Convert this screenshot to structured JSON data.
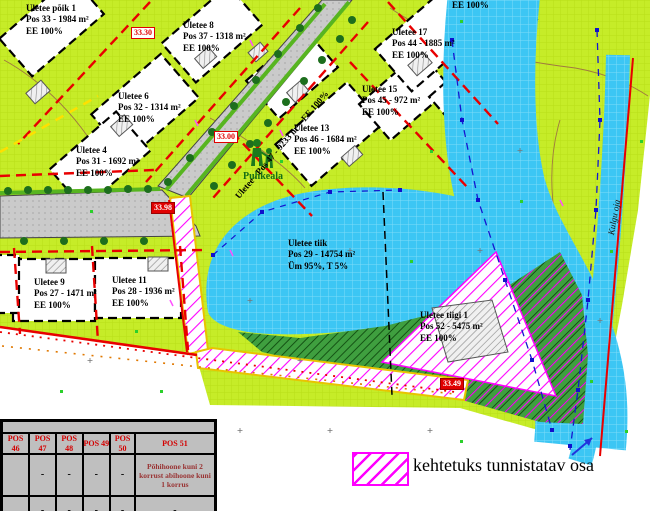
{
  "plots": [
    {
      "l1": "Uletee põik 1",
      "l2": "Pos 33 - 1984 m²",
      "l3": "EE 100%"
    },
    {
      "l1": "Uletee 8",
      "l2": "Pos 37 - 1318 m²",
      "l3": "EE 100%"
    },
    {
      "l1": "Uletee 6",
      "l2": "Pos 32 - 1314 m²",
      "l3": "EE 100%"
    },
    {
      "l1": "Uletee 4",
      "l2": "Pos 31 - 1692 m²",
      "l3": "EE 100%"
    },
    {
      "l1": "Uletee 9",
      "l2": "Pos 27 - 1471 m²",
      "l3": "EE 100%"
    },
    {
      "l1": "Uletee 11",
      "l2": "Pos 28 - 1936 m²",
      "l3": "EE 100%"
    },
    {
      "l1": "Uletee 17",
      "l2": "Pos 44 - 1885 m²",
      "l3": "EE 100%"
    },
    {
      "l1": "Uletee 15",
      "l2": "Pos 45 - 972 m²",
      "l3": "EE 100%"
    },
    {
      "l1": "Uletee 13",
      "l2": "Pos 46 - 1684 m²",
      "l3": "EE 100%"
    },
    {
      "l1": "Uletee tiigi 1",
      "l2": "Pos 52 - 5475 m²",
      "l3": "EE 100%"
    }
  ],
  "pond": {
    "l1": "Uletee tiik",
    "l2": "Pos 29 - 14754 m²",
    "l3": "Üm 95%, T 5%"
  },
  "road_label": "Uletee - Pos 47 - 9233 m² - EE 100%",
  "partial_label": "EE 100%",
  "recreation_label": "Puhkeala",
  "stream_label": "Kulgu oja",
  "elevation_markers": [
    {
      "value": "33.30",
      "style": "outline"
    },
    {
      "value": "33.00",
      "style": "outline"
    },
    {
      "value": "33.98",
      "style": "solid"
    },
    {
      "value": "33.49",
      "style": "solid"
    }
  ],
  "legend": {
    "invalid_part_label": "kehtetuks tunnistatav osa"
  },
  "table": {
    "headers": [
      "POS 46",
      "POS 47",
      "POS 48",
      "POS 49",
      "POS 50",
      "POS 51"
    ],
    "rows": [
      [
        "",
        "-",
        "-",
        "-",
        "-",
        "Põhihoone kuni 2 korrust abihoone kuni 1 korrus"
      ],
      [
        "",
        "-",
        "-",
        "-",
        "-",
        "-"
      ]
    ]
  },
  "colors": {
    "land": "#c6ec28",
    "water": "#3cc6f4",
    "forest": "#3f9f3f",
    "invalid_hatch": "#ff00ff",
    "road": "#cacaca",
    "red_line": "#e80000",
    "marker_red": "#e00000",
    "table_bg": "#bfbfbf"
  }
}
